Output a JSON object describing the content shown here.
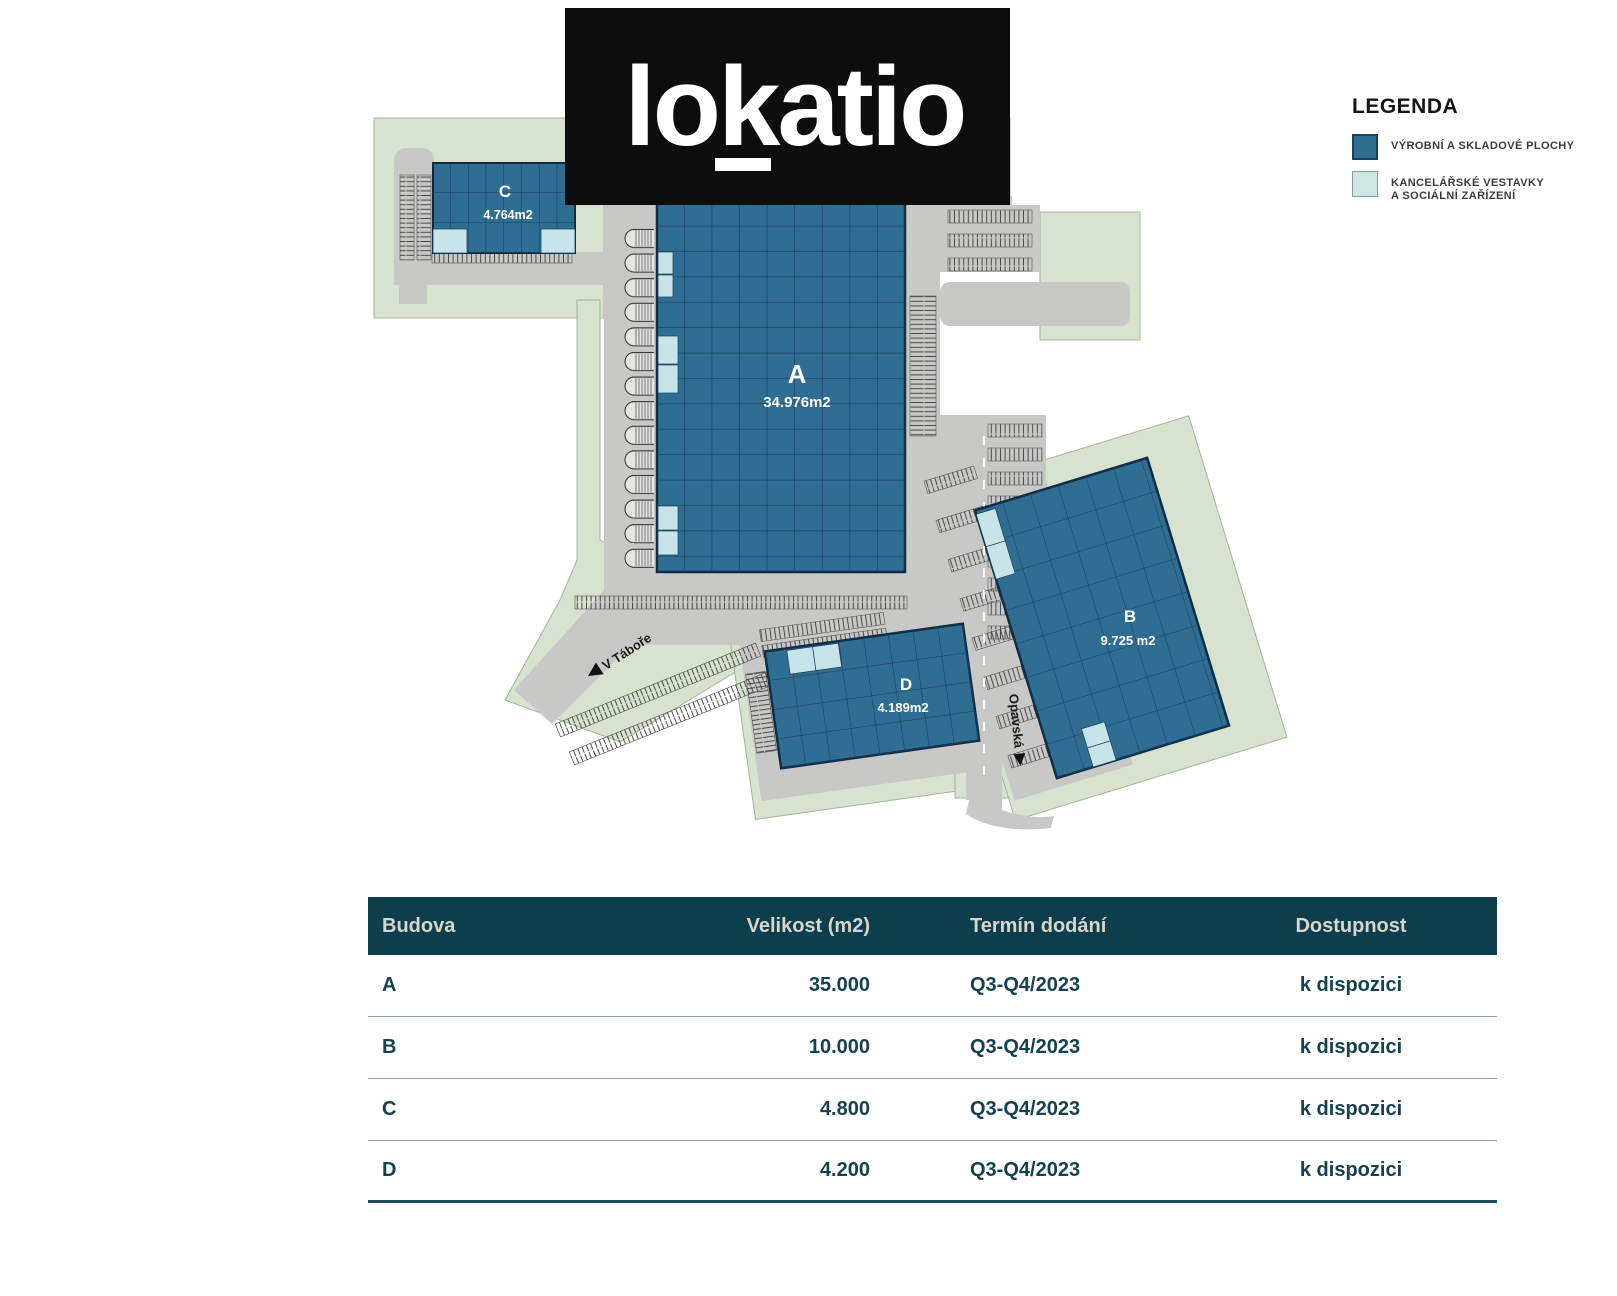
{
  "logo": {
    "text": "lokatio"
  },
  "legend": {
    "title": "LEGENDA",
    "items": [
      {
        "label": "VÝROBNÍ A SKLADOVÉ PLOCHY",
        "color": "#2f6e92"
      },
      {
        "line1": "KANCELÁŘSKÉ VESTAVKY",
        "line2": "A SOCIÁLNÍ ZAŘÍZENÍ",
        "color": "#cfe7e3"
      }
    ]
  },
  "site_plan": {
    "buildings": [
      {
        "id": "A",
        "area": "34.976m2"
      },
      {
        "id": "B",
        "area": "9.725 m2"
      },
      {
        "id": "C",
        "area": "4.764m2"
      },
      {
        "id": "D",
        "area": "4.189m2"
      }
    ],
    "streets": [
      {
        "name": "V Táboře"
      },
      {
        "name": "Opavská"
      }
    ]
  },
  "table": {
    "columns": [
      "Budova",
      "Velikost (m2)",
      "Termín dodání",
      "Dostupnost"
    ],
    "rows": [
      {
        "budova": "A",
        "velikost": "35.000",
        "termin": "Q3-Q4/2023",
        "dostupnost": "k dispozici"
      },
      {
        "budova": "B",
        "velikost": "10.000",
        "termin": "Q3-Q4/2023",
        "dostupnost": "k dispozici"
      },
      {
        "budova": "C",
        "velikost": "4.800",
        "termin": "Q3-Q4/2023",
        "dostupnost": "k dispozici"
      },
      {
        "budova": "D",
        "velikost": "4.200",
        "termin": "Q3-Q4/2023",
        "dostupnost": "k dispozici"
      }
    ]
  },
  "colors": {
    "building_fill": "#2f6e92",
    "office_fill": "#c7e4e8",
    "grid_line": "#1d3f5e",
    "land_green": "#d7e3cf",
    "road_gray": "#c8c8c6",
    "table_header_bg": "#0e3d4b",
    "table_header_text": "#d8d5cd",
    "table_row_text": "#16414f",
    "logo_bg": "#0d0d0d"
  }
}
